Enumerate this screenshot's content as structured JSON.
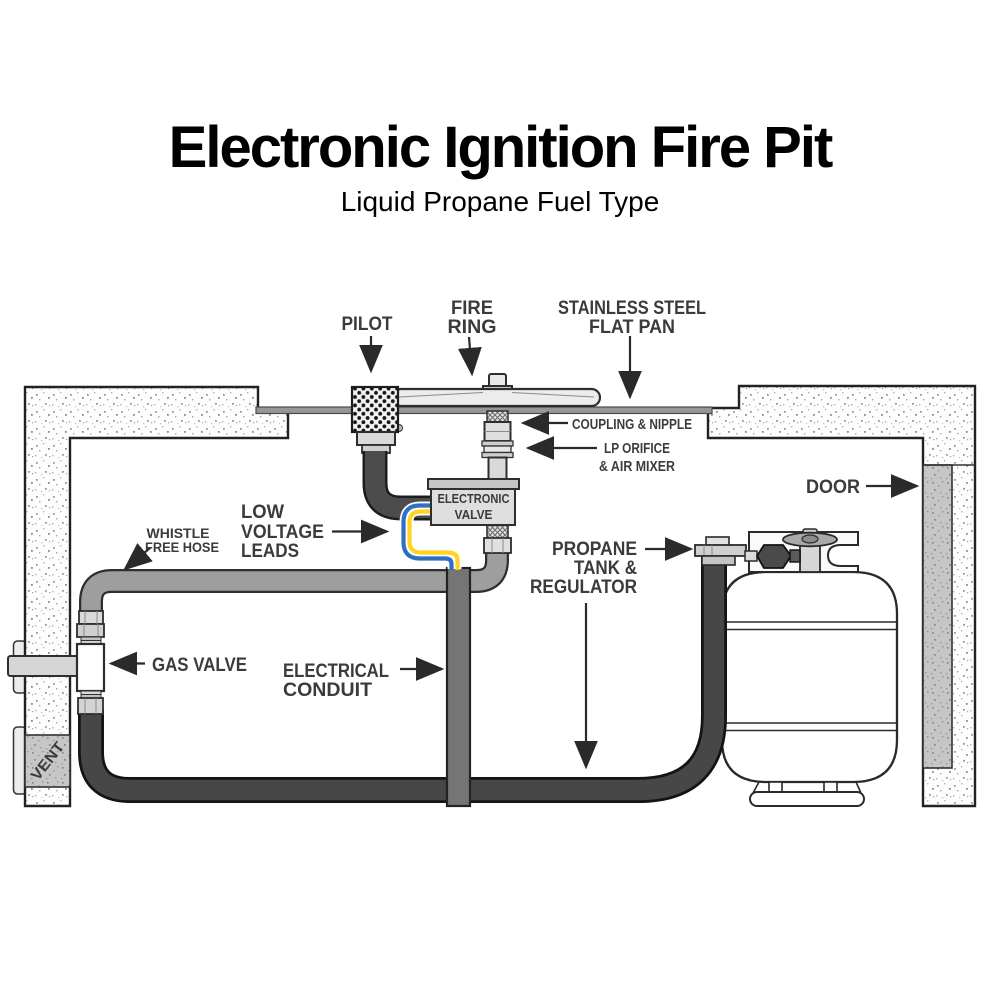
{
  "header": {
    "title": "Electronic Ignition Fire Pit",
    "subtitle": "Liquid Propane Fuel Type"
  },
  "labels": {
    "pilot": [
      "PILOT"
    ],
    "fire_ring": [
      "FIRE",
      "RING"
    ],
    "flat_pan": [
      "STAINLESS STEEL",
      "FLAT PAN"
    ],
    "coupling_nipple": [
      "COUPLING & NIPPLE"
    ],
    "lp_orifice": [
      "LP ORIFICE",
      "& AIR MIXER"
    ],
    "electronic_valve": [
      "ELECTRONIC",
      "VALVE"
    ],
    "door": [
      "DOOR"
    ],
    "whistle_free_hose": [
      "WHISTLE",
      "FREE HOSE"
    ],
    "low_voltage_leads": [
      "LOW",
      "VOLTAGE",
      "LEADS"
    ],
    "gas_valve": [
      "GAS VALVE"
    ],
    "electrical_conduit": [
      "ELECTRICAL",
      "CONDUIT"
    ],
    "propane_tank": [
      "PROPANE",
      "TANK &",
      "REGULATOR"
    ],
    "vent": [
      "VENT"
    ]
  },
  "colors": {
    "title_text": "#000000",
    "label_text": "#3b3b3b",
    "outline": "#2a2a2a",
    "wire_blue": "#2f6fc4",
    "wire_yellow": "#ffd41c",
    "hose_gray": "#9e9e9e",
    "conduit_gray": "#757575",
    "propane_hose": "#474747",
    "component_fill": "#dedede",
    "door_fill": "#c6c6c6",
    "tank_fill": "#ffffff"
  }
}
